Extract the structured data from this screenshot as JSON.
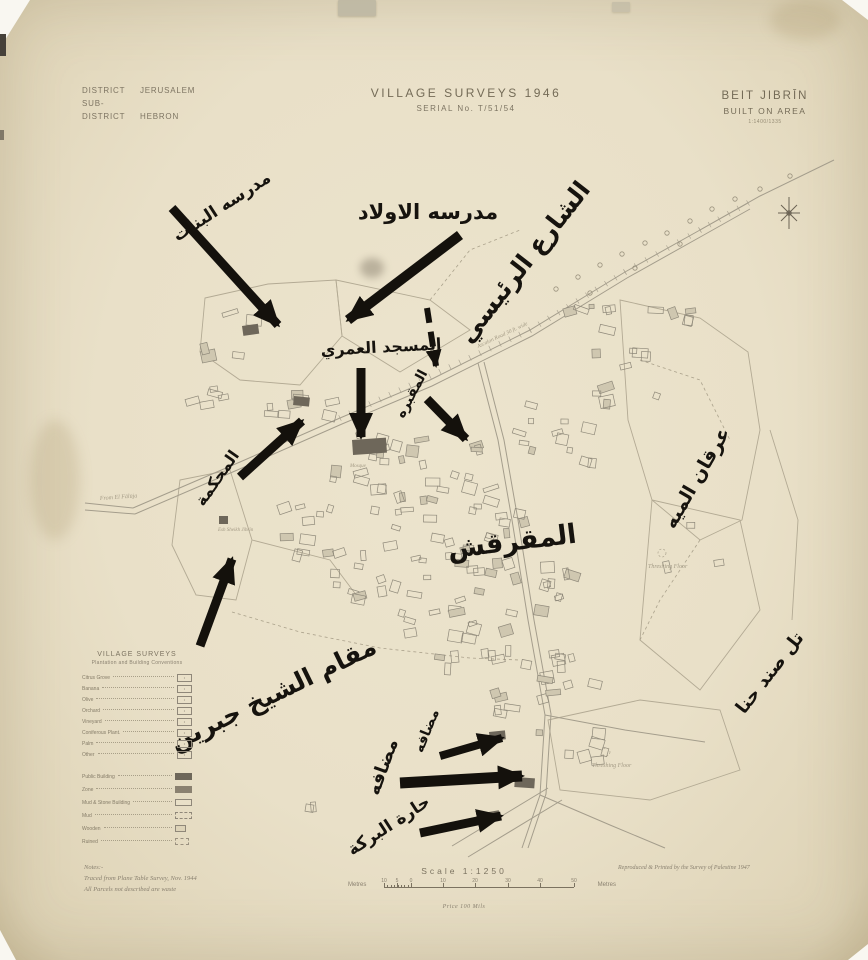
{
  "header": {
    "district_label": "DISTRICT",
    "district_value": "JERUSALEM",
    "subdistrict_label": "SUB-DISTRICT",
    "subdistrict_value": "HEBRON",
    "title": "VILLAGE SURVEYS 1946",
    "serial": "SERIAL No. T/51/54",
    "village_name": "BEIT JIBRĪN",
    "village_sub": "BUILT ON AREA",
    "village_ref": "1:1400/1335"
  },
  "annotations": {
    "girls_school": "مدرسه البنات",
    "boys_school": "مدرسه الاولاد",
    "main_street": "الشارع الرئيسي",
    "omari_mosque": "المسجد العمري",
    "cemetery": "المقبره",
    "court": "المحكمة",
    "irqan_al_miyeh": "عرقان الميه",
    "al_muqarqash": "المقرقش",
    "maqam_sheikh_jibrin": "مقام الشيخ جبرين",
    "tell_sandahanna": "تل صند حنا",
    "madafa_small": "مضافه",
    "madafa_large": "مضافه",
    "harat_al_birkeh": "حارة البركة"
  },
  "map_labels": {
    "threshing_floor_1": "Threshing Floor",
    "threshing_floor_2": "Threshing Floor",
    "from_el_faluja": "From El Fālūja",
    "road_name": "Ascalon Road 30 ft. wide",
    "mosque": "Mosque",
    "sheikh_jibrin": "Esh Sheikh Jibrīn"
  },
  "legend": {
    "title": "VILLAGE SURVEYS",
    "subtitle": "Plantation and Building Conventions",
    "plantation_rows": [
      "Citrus Grove",
      "Banana",
      "Olive",
      "Orchard",
      "Vineyard",
      "Coniferous Plant.",
      "Palm",
      "Other"
    ],
    "building_rows": [
      "Public Building",
      "Zone",
      "Mud & Stone Building",
      "Mud",
      "Wooden",
      "Ruined"
    ]
  },
  "notes": {
    "title": "Notes:-",
    "line1": "Traced from Plane Table Survey, Nov. 1944",
    "line2": "All Parcels not described are waste"
  },
  "scale": {
    "title": "Scale 1:1250",
    "unit_left": "Metres",
    "unit_right": "Metres",
    "ticks": [
      "10",
      "5",
      "0",
      "10",
      "20",
      "30",
      "40",
      "50"
    ],
    "price": "Price 100 Mils"
  },
  "credit": "Reproduced & Printed by the Survey of Palestine 1947",
  "colors": {
    "paper": "#e9e0c8",
    "ink_annotation": "#16130e",
    "ink_print": "#7b7260",
    "map_line": "#a09a8a",
    "building_dark": "#6e675a"
  }
}
